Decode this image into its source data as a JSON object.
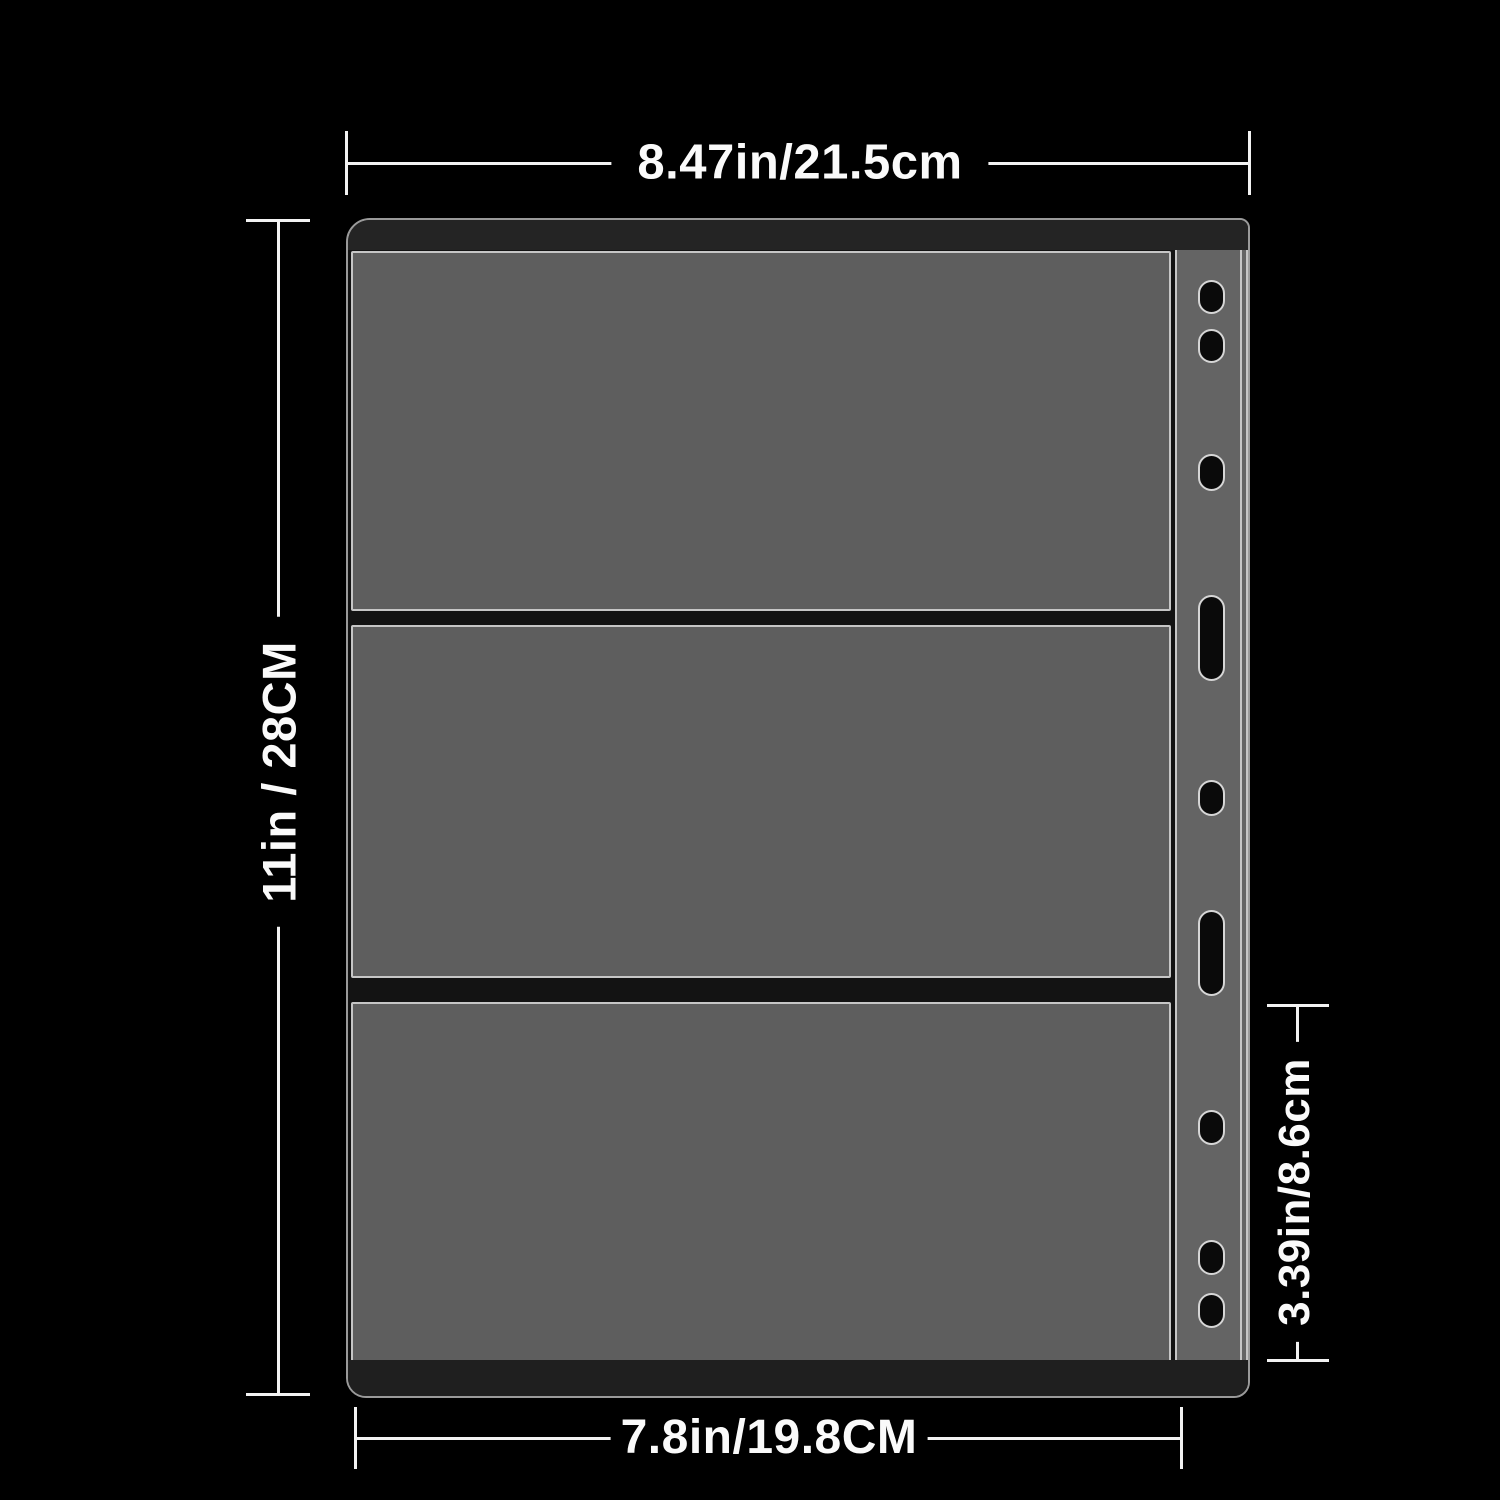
{
  "scene": "Dimension diagram of a 3-pocket binder page (currency/card sleeve) with binder holes, on black background",
  "dimensions": {
    "total_width": "8.47in/21.5cm",
    "total_height": "11in / 28CM",
    "pocket_height": "3.39in/8.6cm",
    "pocket_width": "7.8in/19.8CM"
  },
  "counts": {
    "pockets": 3,
    "binder_holes": 9
  },
  "colors": {
    "background": "#000000",
    "pocket_fill": "#5e5e5e",
    "binder_strip_fill": "#646464",
    "binding_bar": "#242424",
    "outline_white": "#c6c6c6",
    "dimension_marks": "#f2f2f2",
    "hole_fill": "#0a0a0a"
  }
}
